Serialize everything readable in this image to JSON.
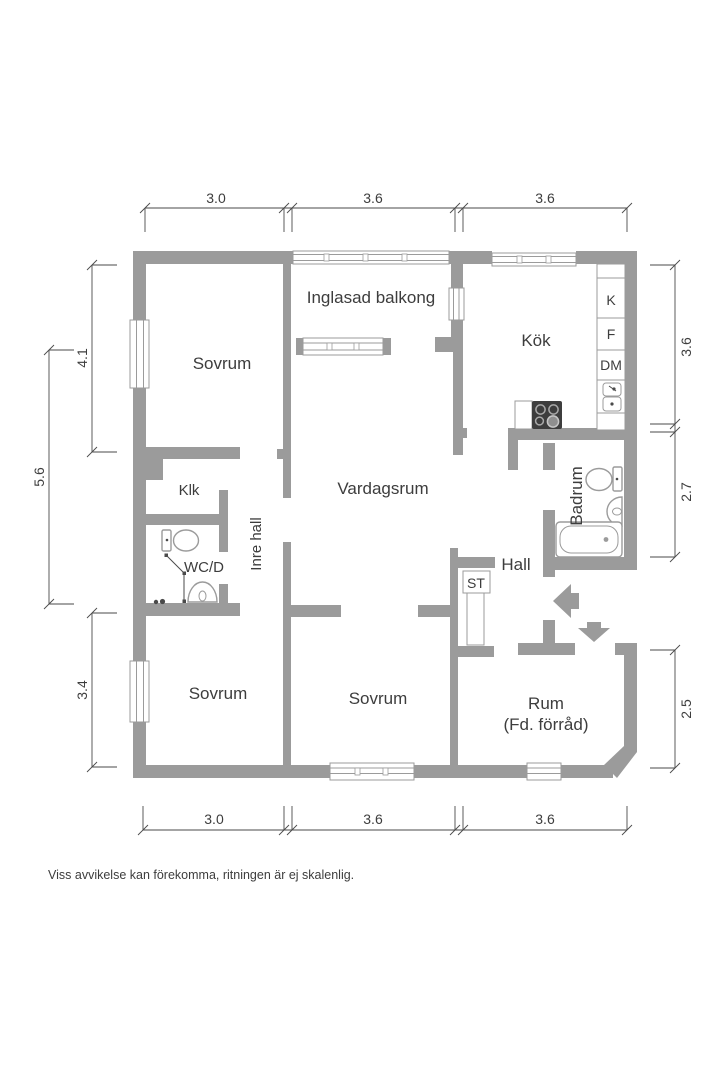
{
  "floor_plan": {
    "rooms": {
      "sovrum_top": "Sovrum",
      "balcony": "Inglasad balkong",
      "kitchen": "Kök",
      "living": "Vardagsrum",
      "klk": "Klk",
      "wcd": "WC/D",
      "inner_hall": "Inre hall",
      "bathroom": "Badrum",
      "hall": "Hall",
      "st": "ST",
      "sovrum_bottom_left": "Sovrum",
      "sovrum_bottom_mid": "Sovrum",
      "rum_line1": "Rum",
      "rum_line2": "(Fd. förråd)"
    },
    "appliances": {
      "k": "K",
      "f": "F",
      "dm": "DM"
    },
    "dimensions": {
      "top": [
        "3.0",
        "3.6",
        "3.6"
      ],
      "bottom": [
        "3.0",
        "3.6",
        "3.6"
      ],
      "left_inner_top": "4.1",
      "left_outer": "5.6",
      "left_inner_bottom": "3.4",
      "right": [
        "3.6",
        "2.7",
        "2.5"
      ]
    },
    "disclaimer": "Viss avvikelse kan förekomma, ritningen är ej skalenlig.",
    "colors": {
      "wall": "#9b9b9b",
      "text": "#3d3d3d",
      "line": "#4a4a4a"
    }
  }
}
